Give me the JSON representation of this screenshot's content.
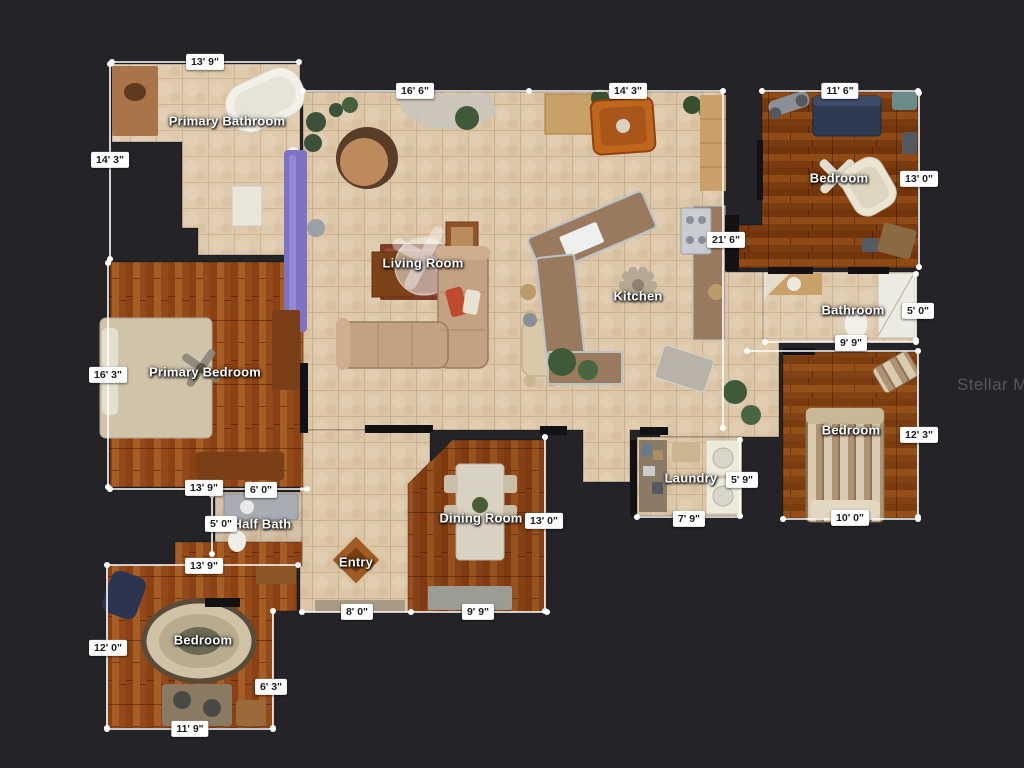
{
  "watermark": "Stellar MLS",
  "colors": {
    "background": "#242428",
    "dimension_line": "#ffffff",
    "chip_background": "#ffffff",
    "chip_text": "#1b1b1b",
    "room_label_text": "#ffffff",
    "tile_floor": "#dcc7a9",
    "wood_floor": "#9a4f1d"
  },
  "rooms": [
    {
      "name": "Primary Bathroom",
      "x": 227,
      "y": 121
    },
    {
      "name": "Living Room",
      "x": 423,
      "y": 263
    },
    {
      "name": "Kitchen",
      "x": 638,
      "y": 296
    },
    {
      "name": "Bedroom",
      "x": 839,
      "y": 178
    },
    {
      "name": "Bathroom",
      "x": 853,
      "y": 310
    },
    {
      "name": "Primary Bedroom",
      "x": 205,
      "y": 372
    },
    {
      "name": "Bedroom",
      "x": 851,
      "y": 430
    },
    {
      "name": "Laundry",
      "x": 691,
      "y": 478
    },
    {
      "name": "Dining Room",
      "x": 481,
      "y": 518
    },
    {
      "name": "Half Bath",
      "x": 262,
      "y": 524
    },
    {
      "name": "Entry",
      "x": 356,
      "y": 562
    },
    {
      "name": "Bedroom",
      "x": 203,
      "y": 640
    }
  ],
  "dimensions": [
    {
      "value": "13' 9\"",
      "x": 205,
      "y": 62
    },
    {
      "value": "14' 3\"",
      "x": 110,
      "y": 160
    },
    {
      "value": "16' 6\"",
      "x": 415,
      "y": 91
    },
    {
      "value": "14' 3\"",
      "x": 628,
      "y": 91
    },
    {
      "value": "11' 6\"",
      "x": 840,
      "y": 91
    },
    {
      "value": "13' 0\"",
      "x": 919,
      "y": 179
    },
    {
      "value": "21' 6\"",
      "x": 726,
      "y": 240
    },
    {
      "value": "5' 0\"",
      "x": 918,
      "y": 311
    },
    {
      "value": "9' 9\"",
      "x": 851,
      "y": 343
    },
    {
      "value": "16' 3\"",
      "x": 108,
      "y": 375
    },
    {
      "value": "12' 3\"",
      "x": 919,
      "y": 435
    },
    {
      "value": "13' 9\"",
      "x": 204,
      "y": 488
    },
    {
      "value": "6' 0\"",
      "x": 261,
      "y": 490
    },
    {
      "value": "5' 0\"",
      "x": 221,
      "y": 524
    },
    {
      "value": "13' 0\"",
      "x": 544,
      "y": 521
    },
    {
      "value": "5' 9\"",
      "x": 742,
      "y": 480
    },
    {
      "value": "7' 9\"",
      "x": 689,
      "y": 519
    },
    {
      "value": "10' 0\"",
      "x": 850,
      "y": 518
    },
    {
      "value": "13' 9\"",
      "x": 204,
      "y": 566
    },
    {
      "value": "8' 0\"",
      "x": 357,
      "y": 612
    },
    {
      "value": "9' 9\"",
      "x": 478,
      "y": 612
    },
    {
      "value": "12' 0\"",
      "x": 108,
      "y": 648
    },
    {
      "value": "6' 3\"",
      "x": 271,
      "y": 687
    },
    {
      "value": "11' 9\"",
      "x": 190,
      "y": 729
    }
  ]
}
